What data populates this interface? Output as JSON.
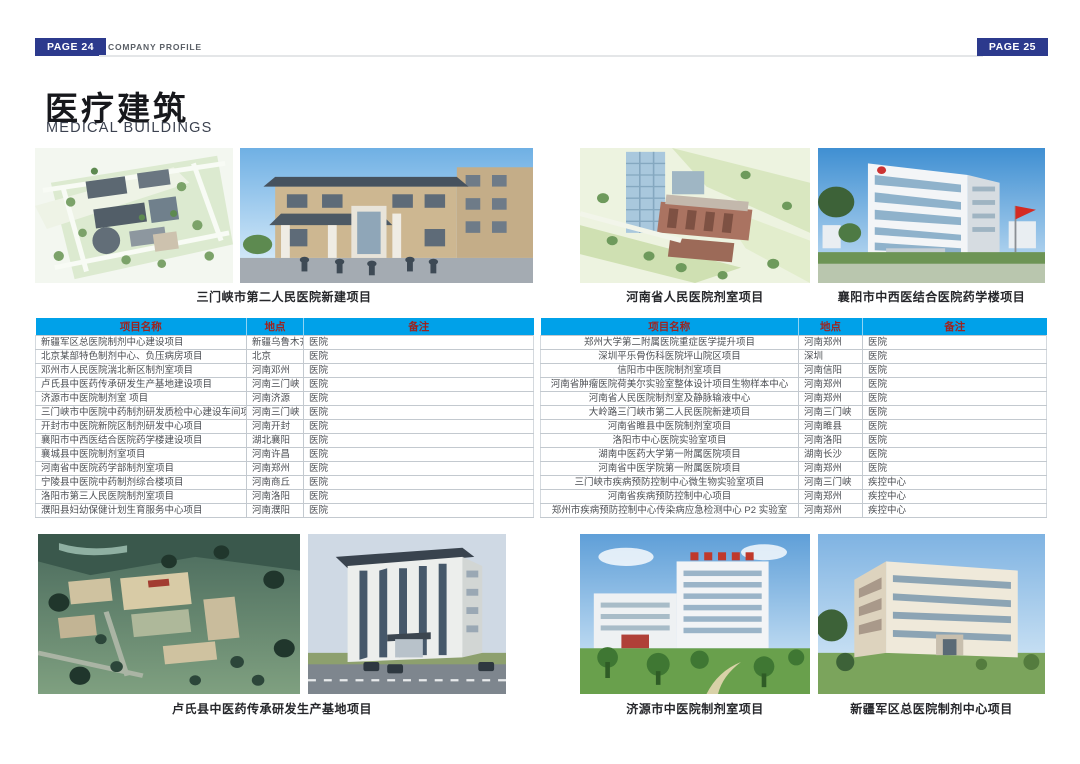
{
  "header": {
    "left_page_badge": "PAGE 24",
    "right_page_badge": "PAGE 25",
    "section_label": "COMPANY PROFILE"
  },
  "title": {
    "zh": "医疗建筑",
    "en": "MEDICAL BUILDINGS"
  },
  "colors": {
    "badge_navy": "#2c3a8d",
    "table_header_blue": "#00a1e9",
    "table_header_text_red": "#9c2420"
  },
  "photo_groups": [
    {
      "caption": "三门峡市第二人民医院新建项目"
    },
    {
      "caption": "河南省人民医院剂室项目"
    },
    {
      "caption": "襄阳市中西医结合医院药学楼项目"
    },
    {
      "caption": "卢氏县中医药传承研发生产基地项目"
    },
    {
      "caption": "济源市中医院制剂室项目"
    },
    {
      "caption": "新疆军区总医院制剂中心项目"
    }
  ],
  "table": {
    "headers": [
      "项目名称",
      "地点",
      "备注"
    ],
    "left_rows": [
      [
        "新疆军区总医院制剂中心建设项目",
        "新疆乌鲁木齐",
        "医院"
      ],
      [
        "北京某部特色制剂中心、负压病房项目",
        "北京",
        "医院"
      ],
      [
        "邓州市人民医院湍北新区制剂室项目",
        "河南邓州",
        "医院"
      ],
      [
        "卢氏县中医药传承研发生产基地建设项目",
        "河南三门峡",
        "医院"
      ],
      [
        "济源市中医院制剂室 项目",
        "河南济源",
        "医院"
      ],
      [
        "三门峡市中医院中药制剂研发质检中心建设车间项目",
        "河南三门峡",
        "医院"
      ],
      [
        "开封市中医院新院区制剂研发中心项目",
        "河南开封",
        "医院"
      ],
      [
        "襄阳市中西医结合医院药学楼建设项目",
        "湖北襄阳",
        "医院"
      ],
      [
        "襄城县中医院制剂室项目",
        "河南许昌",
        "医院"
      ],
      [
        "河南省中医院药学部制剂室项目",
        "河南郑州",
        "医院"
      ],
      [
        "宁陵县中医院中药制剂综合楼项目",
        "河南商丘",
        "医院"
      ],
      [
        "洛阳市第三人民医院制剂室项目",
        "河南洛阳",
        "医院"
      ],
      [
        "濮阳县妇幼保健计划生育服务中心项目",
        "河南濮阳",
        "医院"
      ]
    ],
    "right_rows": [
      [
        "郑州大学第二附属医院重症医学提升项目",
        "河南郑州",
        "医院"
      ],
      [
        "深圳平乐骨伤科医院坪山院区项目",
        "深圳",
        "医院"
      ],
      [
        "信阳市中医院制剂室项目",
        "河南信阳",
        "医院"
      ],
      [
        "河南省肿瘤医院荷美尔实验室整体设计项目生物样本中心",
        "河南郑州",
        "医院"
      ],
      [
        "河南省人民医院制剂室及静脉输液中心",
        "河南郑州",
        "医院"
      ],
      [
        "大岭路三门峡市第二人民医院新建项目",
        "河南三门峡",
        "医院"
      ],
      [
        "河南省睢县中医院制剂室项目",
        "河南睢县",
        "医院"
      ],
      [
        "洛阳市中心医院实验室项目",
        "河南洛阳",
        "医院"
      ],
      [
        "湖南中医药大学第一附属医院项目",
        "湖南长沙",
        "医院"
      ],
      [
        "河南省中医学院第一附属医院项目",
        "河南郑州",
        "医院"
      ],
      [
        "三门峡市疾病预防控制中心微生物实验室项目",
        "河南三门峡",
        "疾控中心"
      ],
      [
        "河南省疾病预防控制中心项目",
        "河南郑州",
        "疾控中心"
      ],
      [
        "郑州市疾病预防控制中心传染病应急检测中心 P2 实验室",
        "河南郑州",
        "疾控中心"
      ]
    ]
  }
}
